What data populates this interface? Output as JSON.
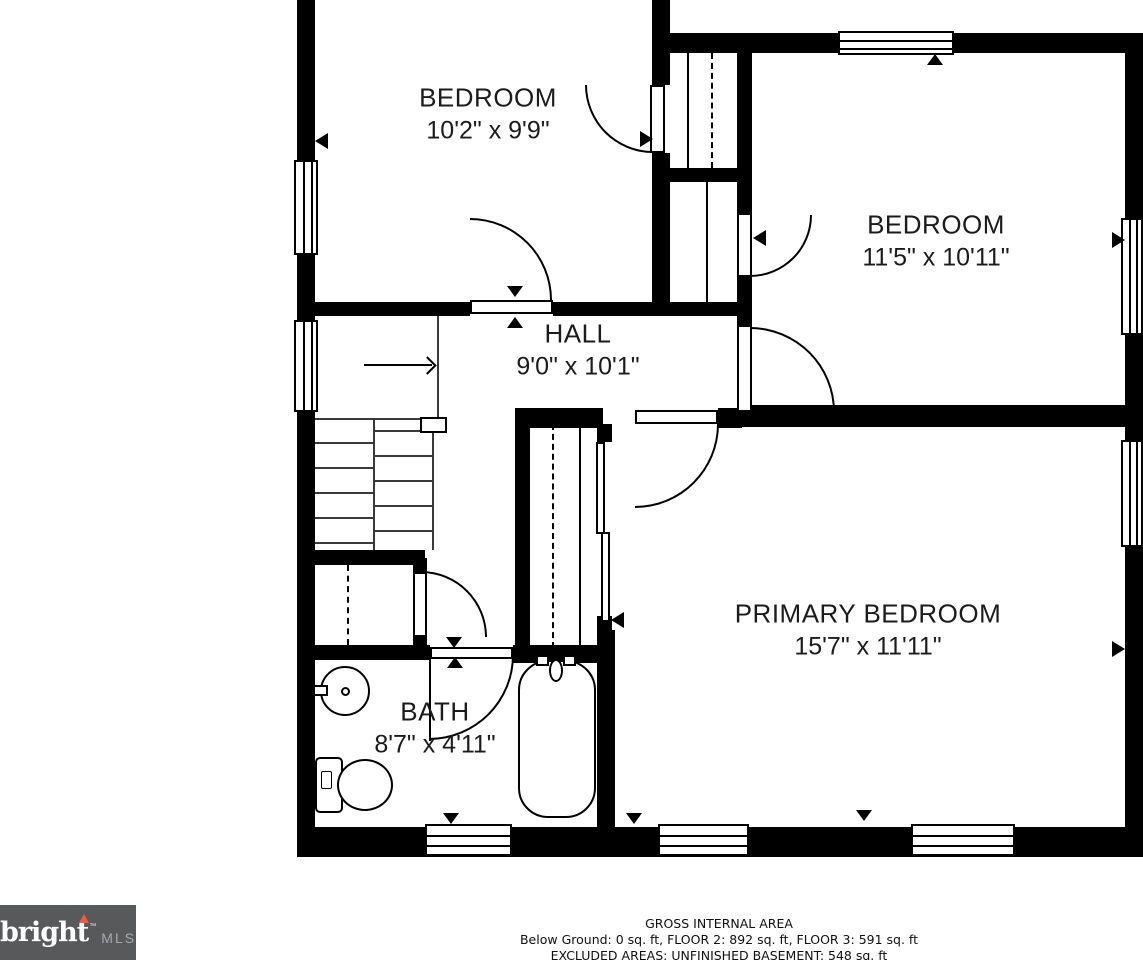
{
  "rooms": [
    {
      "name": "BEDROOM",
      "dimensions": "10'2\" x 9'9\""
    },
    {
      "name": "BEDROOM",
      "dimensions": "11'5\" x 10'11\""
    },
    {
      "name": "HALL",
      "dimensions": "9'0\" x 10'1\""
    },
    {
      "name": "PRIMARY BEDROOM",
      "dimensions": "15'7\" x 11'11\""
    },
    {
      "name": "BATH",
      "dimensions": "8'7\" x 4'11\""
    }
  ],
  "footer": {
    "title": "GROSS INTERNAL AREA",
    "areas": "Below Ground: 0 sq. ft, FLOOR 2: 892 sq. ft, FLOOR 3: 591 sq. ft",
    "excluded": "EXCLUDED AREAS: UNFINISHED BASEMENT: 548 sq. ft"
  },
  "logo": {
    "brand": "bright",
    "trademark": "™",
    "suffix": "MLS"
  },
  "colors": {
    "wall": "#000000",
    "background": "#ffffff",
    "logo_background": "#58595b",
    "logo_text": "#ffffff",
    "logo_accent": "#f15b40",
    "logo_suffix": "#a7a9ac",
    "label_text": "#1b1b1b"
  }
}
